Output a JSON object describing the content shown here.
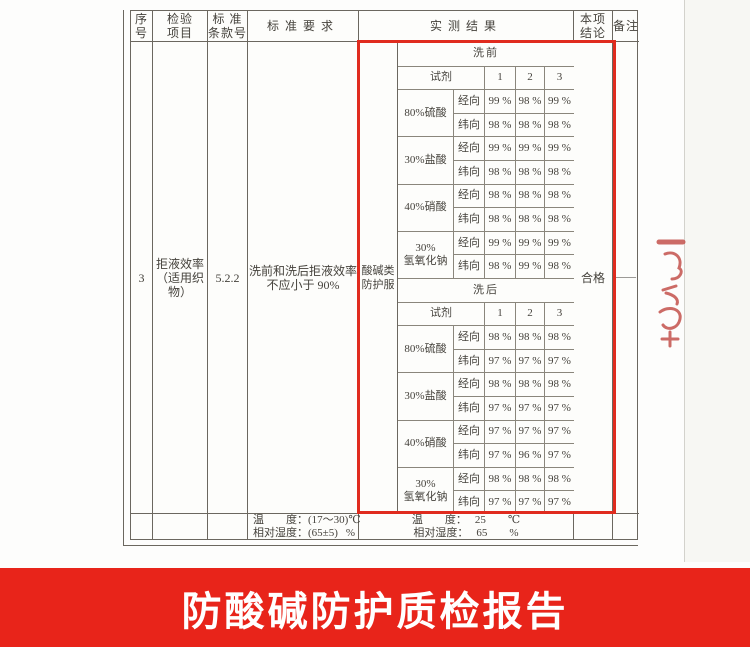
{
  "report": {
    "headers": {
      "seq": [
        "序",
        "号"
      ],
      "item": [
        "检验",
        "项目"
      ],
      "clause": [
        "标 准",
        "条款号"
      ],
      "requirement": "标准要求",
      "result": "实测结果",
      "conclusion": [
        "本项",
        "结论"
      ],
      "remark": "备注"
    },
    "row": {
      "seq": "3",
      "item": [
        "拒液效率",
        "（适用织物）"
      ],
      "clause": "5.2.2",
      "requirement": [
        "洗前和洗后拒液效率",
        "不应小于 90%"
      ],
      "category": [
        "酸碱类",
        "防护服"
      ],
      "conclusion": "合格",
      "remark": "——"
    },
    "results": {
      "reagent_label": "试剂",
      "col_headers": [
        "1",
        "2",
        "3"
      ],
      "unit": "%",
      "sections": [
        {
          "phase": "洗前",
          "rows": [
            {
              "reagent": [
                "80%硫酸"
              ],
              "dirs": [
                {
                  "label": "经向",
                  "values": [
                    99,
                    98,
                    99
                  ]
                },
                {
                  "label": "纬向",
                  "values": [
                    98,
                    98,
                    98
                  ]
                }
              ]
            },
            {
              "reagent": [
                "30%盐酸"
              ],
              "dirs": [
                {
                  "label": "经向",
                  "values": [
                    99,
                    99,
                    99
                  ]
                },
                {
                  "label": "纬向",
                  "values": [
                    98,
                    98,
                    98
                  ]
                }
              ]
            },
            {
              "reagent": [
                "40%硝酸"
              ],
              "dirs": [
                {
                  "label": "经向",
                  "values": [
                    98,
                    98,
                    98
                  ]
                },
                {
                  "label": "纬向",
                  "values": [
                    98,
                    98,
                    98
                  ]
                }
              ]
            },
            {
              "reagent": [
                "30%",
                "氢氧化钠"
              ],
              "dirs": [
                {
                  "label": "经向",
                  "values": [
                    99,
                    99,
                    99
                  ]
                },
                {
                  "label": "纬向",
                  "values": [
                    98,
                    99,
                    98
                  ]
                }
              ]
            }
          ]
        },
        {
          "phase": "洗后",
          "rows": [
            {
              "reagent": [
                "80%硫酸"
              ],
              "dirs": [
                {
                  "label": "经向",
                  "values": [
                    98,
                    98,
                    98
                  ]
                },
                {
                  "label": "纬向",
                  "values": [
                    97,
                    97,
                    97
                  ]
                }
              ]
            },
            {
              "reagent": [
                "30%盐酸"
              ],
              "dirs": [
                {
                  "label": "经向",
                  "values": [
                    98,
                    98,
                    98
                  ]
                },
                {
                  "label": "纬向",
                  "values": [
                    97,
                    97,
                    97
                  ]
                }
              ]
            },
            {
              "reagent": [
                "40%硝酸"
              ],
              "dirs": [
                {
                  "label": "经向",
                  "values": [
                    97,
                    97,
                    97
                  ]
                },
                {
                  "label": "纬向",
                  "values": [
                    97,
                    96,
                    97
                  ]
                }
              ]
            },
            {
              "reagent": [
                "30%",
                "氢氧化钠"
              ],
              "dirs": [
                {
                  "label": "经向",
                  "values": [
                    98,
                    98,
                    98
                  ]
                },
                {
                  "label": "纬向",
                  "values": [
                    97,
                    97,
                    97
                  ]
                }
              ]
            }
          ]
        }
      ]
    },
    "environment": {
      "standard": {
        "temperature_label": "温　　度：",
        "temperature_value": "(17～30)℃",
        "humidity_label": "相对湿度：",
        "humidity_value": "(65±5)",
        "humidity_unit": "%"
      },
      "actual": {
        "temperature_label": "温　　度：",
        "temperature_value": "25",
        "temperature_unit": "℃",
        "humidity_label": "相对湿度：",
        "humidity_value": "65",
        "humidity_unit": "%"
      }
    }
  },
  "banner": {
    "title": "防酸碱防护质检报告"
  },
  "colors": {
    "banner_background": "#e8241a",
    "highlight_box": "#e02b1e",
    "table_border": "#6b675f",
    "stamp_red": "#c4524c",
    "text": "#45423c"
  }
}
